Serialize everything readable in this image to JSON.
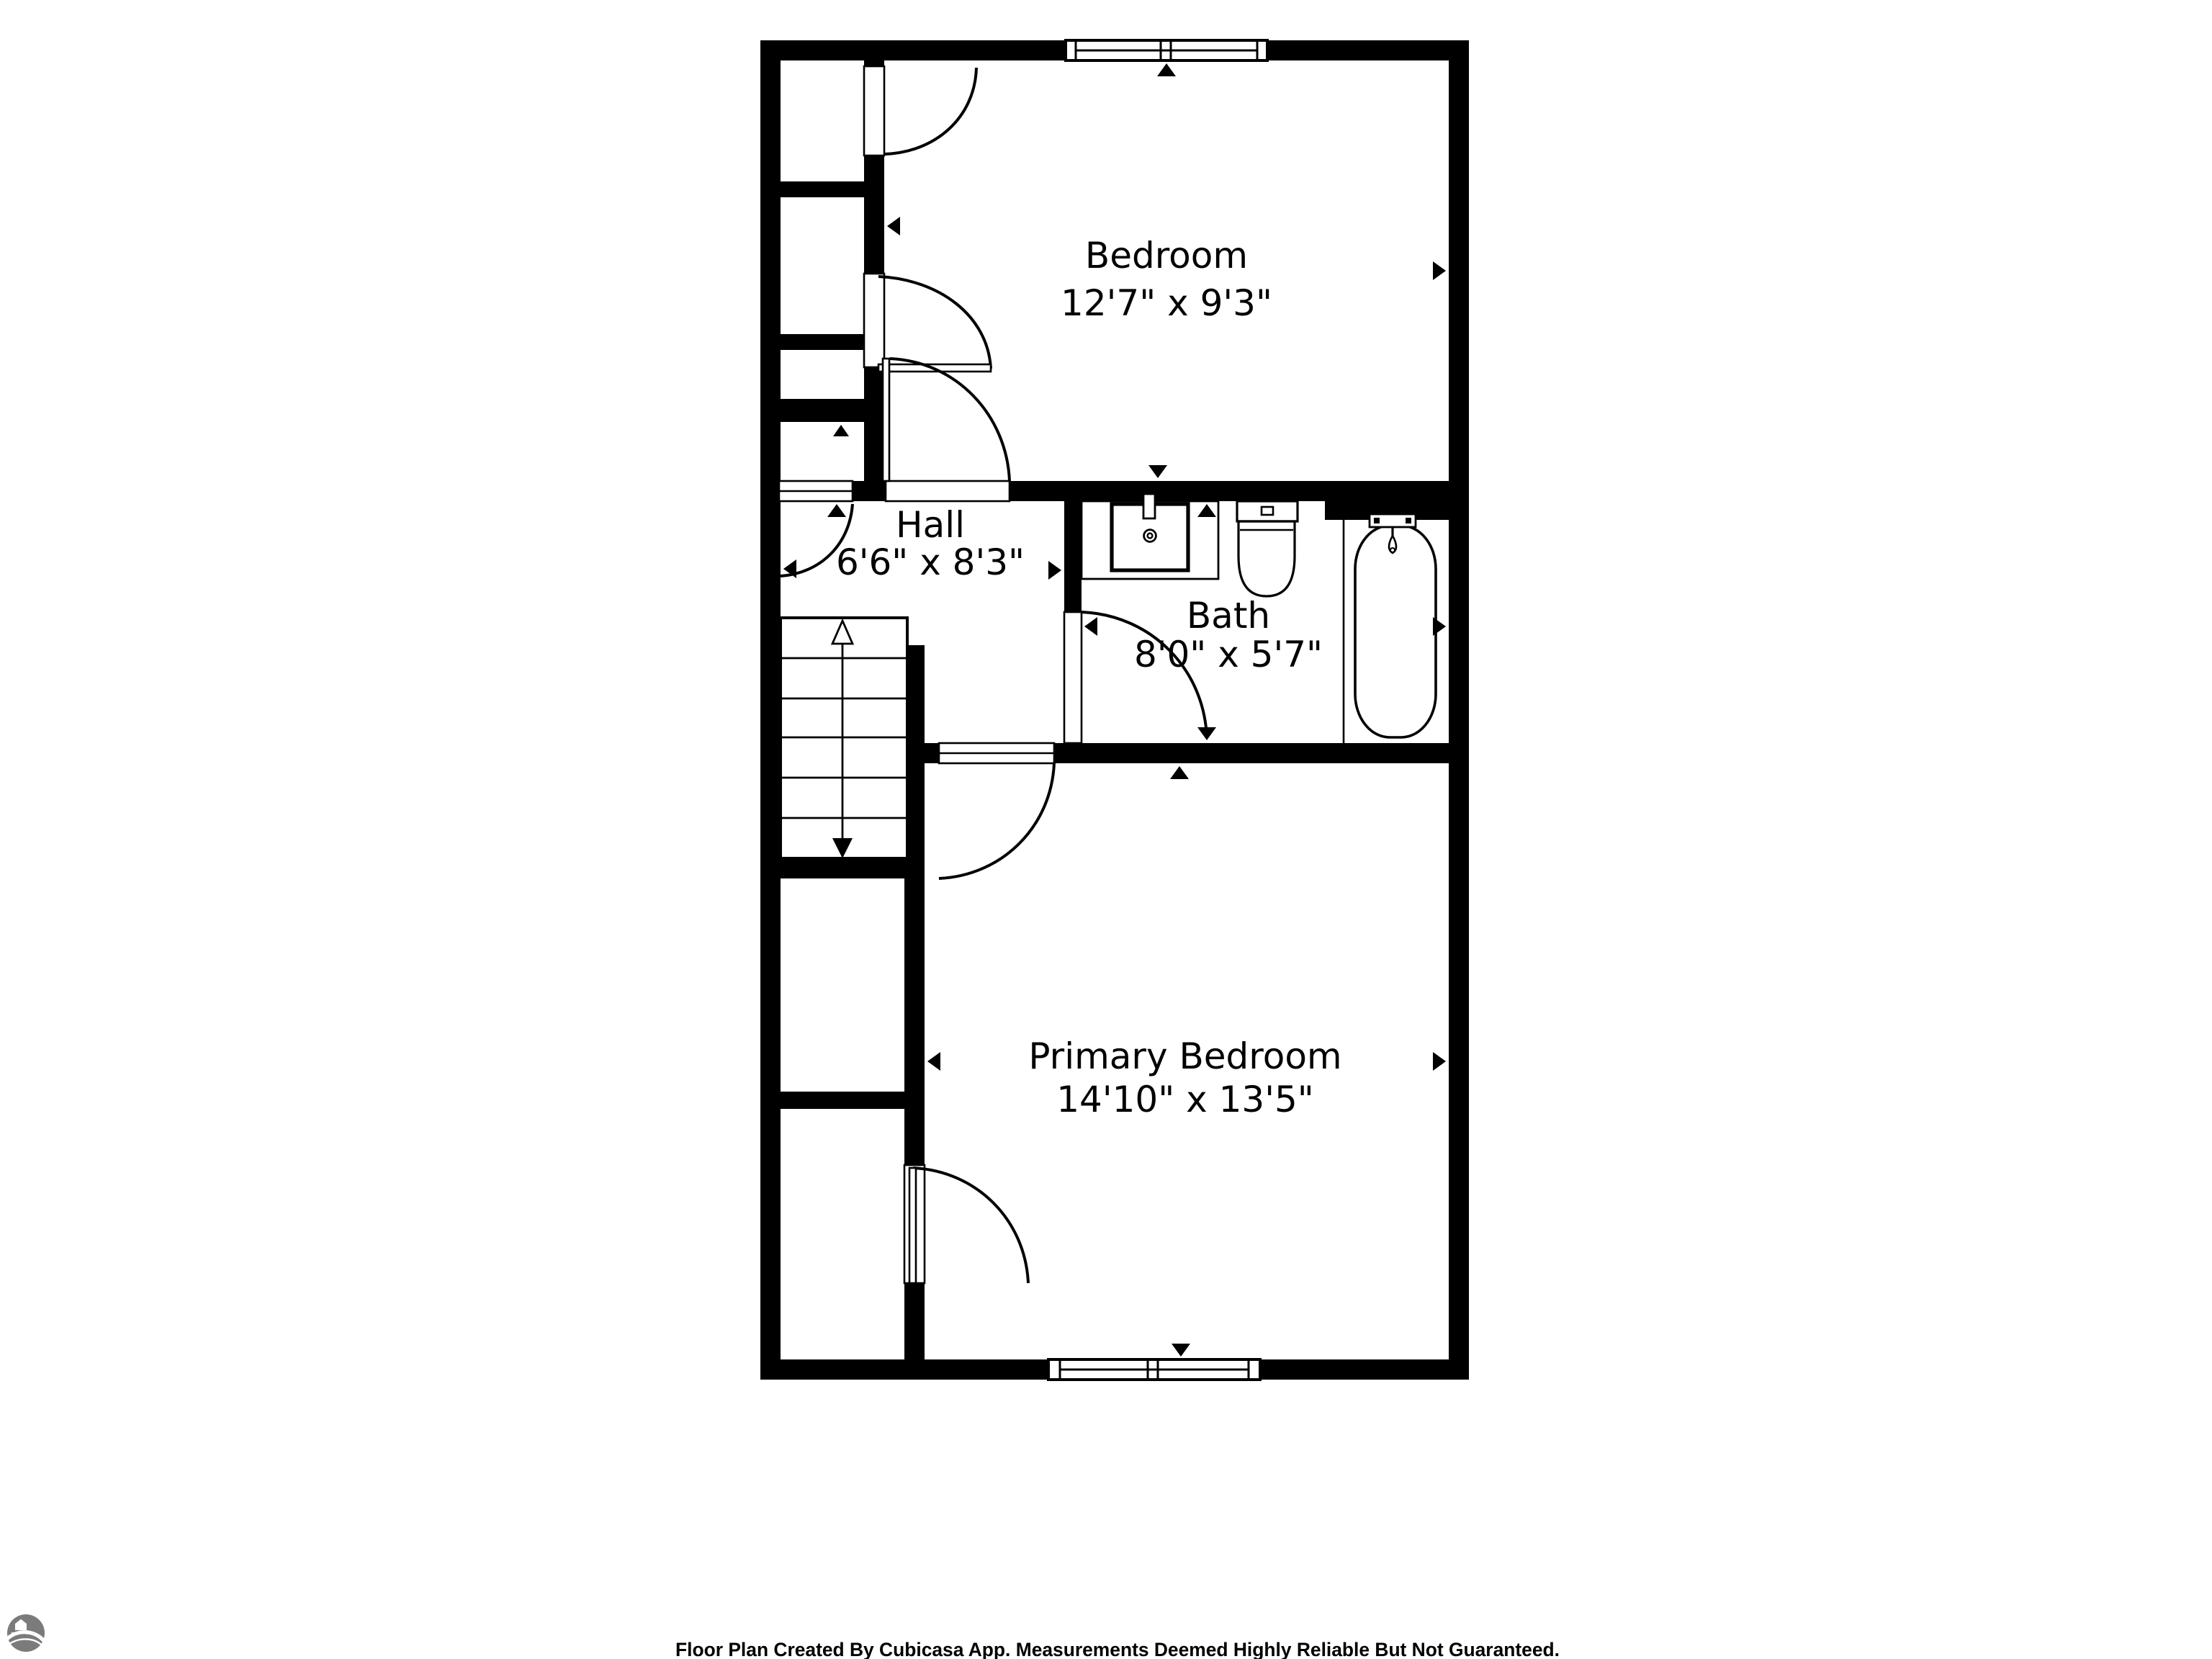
{
  "rooms": {
    "bedroom": {
      "name": "Bedroom",
      "dims": "12'7\" x 9'3\""
    },
    "hall": {
      "name": "Hall",
      "dims": "6'6\" x 8'3\""
    },
    "bath": {
      "name": "Bath",
      "dims": "8'0\" x 5'7\""
    },
    "primary": {
      "name": "Primary Bedroom",
      "dims": "14'10\" x 13'5\""
    }
  },
  "footer": {
    "text": "Floor Plan Created By Cubicasa App. Measurements Deemed Highly Reliable But Not Guaranteed."
  },
  "colors": {
    "wall": "#000000",
    "background": "#ffffff",
    "logo_gray": "#7b7b7b"
  }
}
